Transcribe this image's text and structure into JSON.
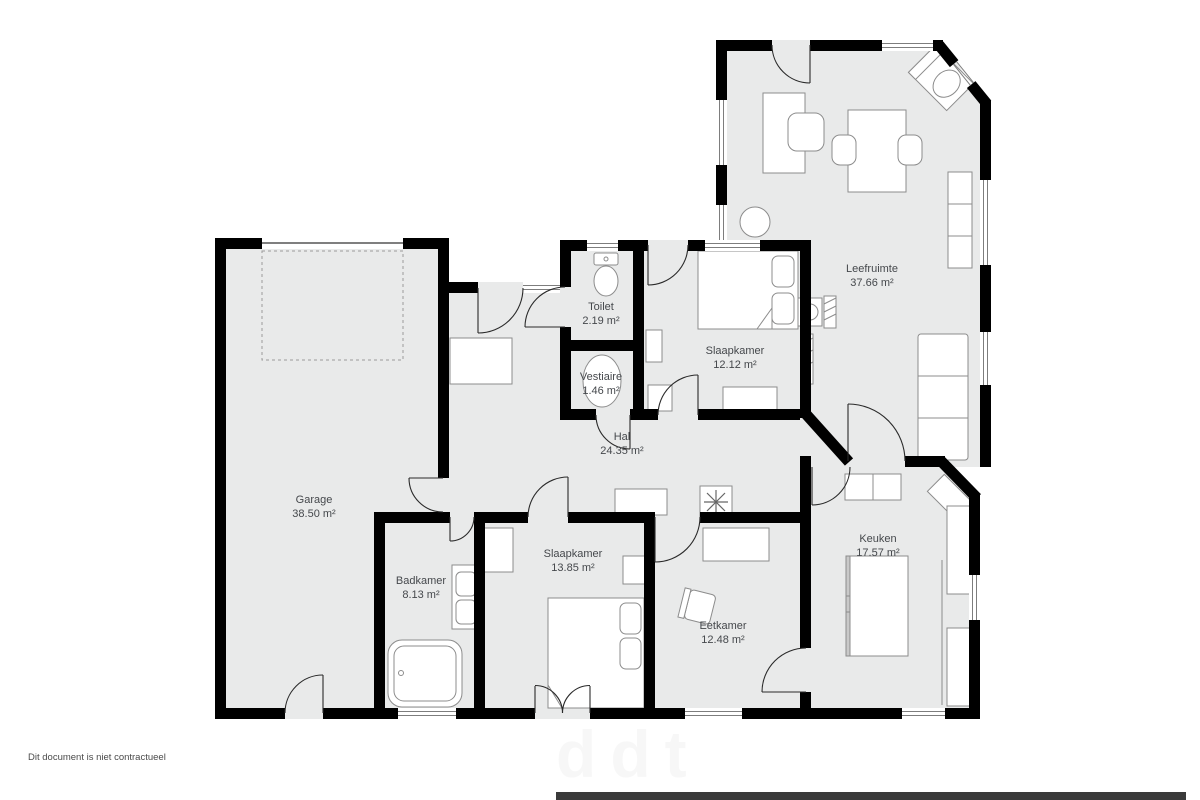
{
  "footer": {
    "disclaimer": "Dit document is niet contractueel"
  },
  "watermark": {
    "text": "ddt"
  },
  "floorplan": {
    "area_unit": "m²",
    "colors": {
      "floor": "#e9eaea",
      "wall": "#000000",
      "furniture_fill": "#ffffff",
      "furniture_stroke": "#8c8c8c",
      "label_text": "#45484c"
    },
    "rooms": [
      {
        "id": "leefruimte",
        "name": "Leefruimte",
        "area": "37.66 m²"
      },
      {
        "id": "slaapkamer-1",
        "name": "Slaapkamer",
        "area": "12.12 m²"
      },
      {
        "id": "toilet",
        "name": "Toilet",
        "area": "2.19 m²"
      },
      {
        "id": "vestiaire",
        "name": "Vestiaire",
        "area": "1.46 m²"
      },
      {
        "id": "hal",
        "name": "Hal",
        "area": "24.35 m²"
      },
      {
        "id": "garage",
        "name": "Garage",
        "area": "38.50 m²"
      },
      {
        "id": "badkamer",
        "name": "Badkamer",
        "area": "8.13 m²"
      },
      {
        "id": "slaapkamer-2",
        "name": "Slaapkamer",
        "area": "13.85 m²"
      },
      {
        "id": "eetkamer",
        "name": "Eetkamer",
        "area": "12.48 m²"
      },
      {
        "id": "keuken",
        "name": "Keuken",
        "area": "17.57 m²"
      }
    ]
  }
}
